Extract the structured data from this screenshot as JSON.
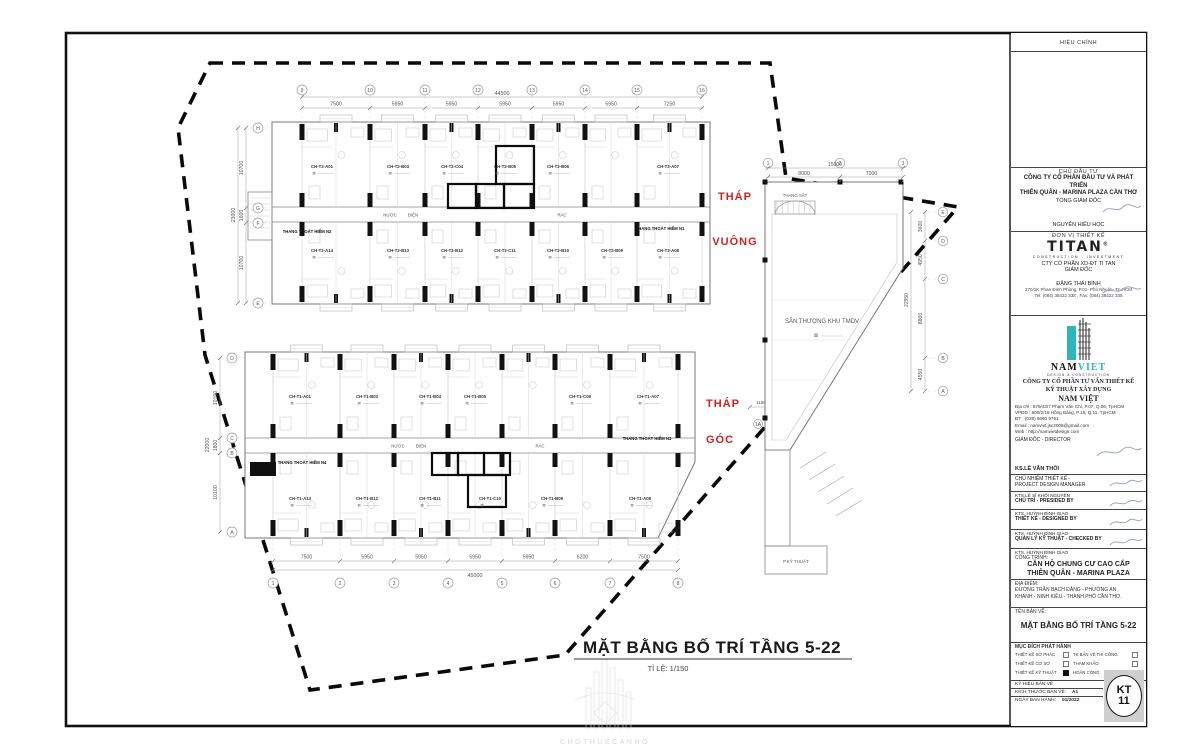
{
  "sheet": {
    "main_title": "MẶT BẰNG BỐ TRÍ TẦNG 5-22",
    "scale_label": "TỈ LỆ: 1/150",
    "watermark_text": "CHOTHUECANHO"
  },
  "annotations": {
    "tower_square_line1": "THÁP",
    "tower_square_line2": "VUÔNG",
    "tower_corner_line1": "THÁP",
    "tower_corner_line2": "GÓC",
    "terrace_label": "SÂN THƯỢNG KHU TMDV",
    "steel_stair_label": "THANG SẮT",
    "tech_room_label": "P.KỸ THUẬT"
  },
  "upper_plan": {
    "grids_top": [
      "9",
      "10",
      "11",
      "12",
      "13",
      "14",
      "15",
      "16"
    ],
    "dims_top": [
      "7500",
      "5950",
      "5950",
      "5950",
      "5950",
      "5950",
      "7250"
    ],
    "total_top": "44500",
    "grids_left": [
      "H",
      "G",
      "F",
      "E"
    ],
    "dims_left": [
      "10700",
      "1600",
      "10700"
    ],
    "total_left": "23000",
    "units_top": [
      "CH-T2-A01",
      "CH-T2-B03",
      "CH-T2-C04",
      "CH-T2-B05",
      "CH-T2-B06",
      "CH-T2-A07"
    ],
    "units_bottom": [
      "CH-T2-A14",
      "CH-T2-B13",
      "CH-T2-B12",
      "CH-T2-C11",
      "CH-T2-B10",
      "CH-T2-B09",
      "CH-T2-A08"
    ],
    "stair_left": "THANG THOÁT HIỂM N2",
    "stair_right": "THANG THOÁT HIỂM N1",
    "service_labels": [
      "NƯỚC",
      "ĐIỆN",
      "RÁC"
    ]
  },
  "lower_plan": {
    "grids_bottom": [
      "1",
      "2",
      "3",
      "4",
      "5",
      "6",
      "7",
      "8"
    ],
    "dims_bottom": [
      "7500",
      "5950",
      "5950",
      "5950",
      "5950",
      "6200",
      "7500"
    ],
    "total_bottom": "45000",
    "grids_left": [
      "D",
      "C",
      "B",
      "A"
    ],
    "dims_left": [
      "10100",
      "1800",
      "10100"
    ],
    "total_left": "22000",
    "units_top": [
      "CH-T1-A01",
      "CH-T1-B03",
      "CH-T1-B04",
      "CH-T1-B05",
      "CH-T1-C06",
      "CH-T1-A07"
    ],
    "units_bottom": [
      "CH-T1-A13",
      "CH-T1-B12",
      "CH-T1-B11",
      "CH-T1-C10",
      "CH-T1-B09",
      "CH-T1-A08"
    ],
    "stair_left": "THANG THOÁT HIỂM N4",
    "stair_right": "THANG THOÁT HIỂM N3",
    "service_labels": [
      "NƯỚC",
      "ĐIỆN",
      "RÁC"
    ],
    "corner_dims": [
      "1150",
      "950",
      "2100"
    ],
    "corner_grids": [
      "1A",
      "1B"
    ]
  },
  "wing_plan": {
    "grids_top": [
      "1",
      "2",
      "3"
    ],
    "dims_top": [
      "8000",
      "7000"
    ],
    "total_top": "15000",
    "grids_right": [
      "E",
      "D",
      "C",
      "B",
      "A"
    ],
    "dims_right": [
      "3600",
      "4950",
      "8800",
      "4550"
    ],
    "total_right": "22950"
  },
  "title_block": {
    "revision_header": "HIỆU CHỈNH",
    "investor_header": "CHỦ ĐẦU TƯ",
    "investor_name1": "CÔNG TY CỔ PHẦN ĐẦU TƯ VÀ PHÁT TRIỂN",
    "investor_name2": "THIÊN QUÂN - MARINA PLAZA CẦN THƠ",
    "investor_role": "TỔNG GIÁM ĐỐC",
    "investor_signer": "NGUYỄN HIẾU HỌC",
    "designer_header": "ĐƠN VỊ THIẾT KẾ",
    "titan_word": "TITAN",
    "titan_reg": "®",
    "titan_sub": "CONSTRUCTION - INVESTMENT",
    "titan_company": "CTY CỔ PHẦN XD-ĐT TI TAN",
    "titan_role": "GIÁM ĐỐC",
    "titan_signer": "ĐẶNG THÁI BÌNH",
    "titan_addr": "270/1K Phan Đình Phùng, P.01- Phú Nhuận- Tp.HCM",
    "titan_tel": "Tel: (084) 38422 338 , Fax: (084) 38422 335",
    "nv_nam": "NAM",
    "nv_viet": "VIET",
    "nv_logo_sub": "DESIGN & CONSTRUCTION",
    "nv_line1": "CÔNG TY CỔ PHẦN TƯ VẤN THIẾT KẾ",
    "nv_line2": "KỸ THUẬT XÂY DỰNG",
    "nv_name": "NAM VIỆT",
    "nv_addr1": "Địa chỉ : 579/43/7 Phạm Văn Chí, P.07, Q.06, TpHCM",
    "nv_addr2": "VPĐD : 600/2/18 Hồng Bàng, P.16, Q.11, TpHCM",
    "nv_addr3": "ĐT : (028) 6660 9761",
    "nv_addr4": "Email : namviet.jsc2008@gmail.com",
    "nv_addr5": "Web : http://namvietdesign.com",
    "nv_role": "GIÁM ĐỐC - DIRECTOR",
    "nv_signer": "KS.LÊ VĂN THỐI",
    "pm_label1": "CHỦ NHIỆM THIẾT KẾ -",
    "pm_label2": "PROJECT DESIGN MANAGER",
    "pm_name": "KTS.LÊ SĨ KHÔI NGUYÊN",
    "presided_label": "CHỦ TRÌ - PRESIDED  BY",
    "presided_name": "KTS. HUỲNH ĐÌNH GIAO",
    "designed_label": "THIẾT KẾ - DESIGNED BY",
    "designed_name": "KTS. HUỲNH ĐÌNH GIAO",
    "checked_label": "QUẢN LÝ KỸ THUẬT - CHECKED BY",
    "checked_name": "KTS. HUỲNH ĐÌNH GIAO",
    "project_header": "CÔNG TRÌNH:",
    "project_name1": "CĂN HỘ CHUNG CƯ CAO CẤP",
    "project_name2": "THIÊN QUÂN - MARINA PLAZA",
    "location_header": "ĐỊA ĐIỂM:",
    "location_line1": "ĐƯỜNG TRẦN BẠCH ĐẰNG - PHƯỜNG AN",
    "location_line2": "KHÁNH - NINH KIỀU - THÀNH PHỐ CẦN THƠ.",
    "drawing_header": "TÊN BẢN VẼ:",
    "drawing_name": "MẶT BẰNG BỐ TRÍ TẦNG 5-22",
    "purpose_header": "MỤC ĐÍCH PHÁT HÀNH",
    "purpose_items": [
      {
        "label": "THIẾT KẾ SƠ PHÁC",
        "checked": false
      },
      {
        "label": "TK BẢN VẼ THI CÔNG",
        "checked": false
      },
      {
        "label": "THIẾT KẾ CƠ SỞ",
        "checked": false
      },
      {
        "label": "THAM KHẢO",
        "checked": false
      },
      {
        "label": "THIẾT KẾ KỸ THUẬT",
        "checked": true
      },
      {
        "label": "HOÀN CÔNG",
        "checked": false
      }
    ],
    "symbol_label": "KÝ HIỆU BẢN VẼ",
    "size_label": "KÍCH THƯỚC BẢN VẼ:",
    "size_value": "A1",
    "date_label": "NGÀY BAN HÀNH:",
    "date_value": "01/2022",
    "sheet_code_top": "KT",
    "sheet_code_bottom": "11"
  },
  "colors": {
    "red_label": "#d42020",
    "teal_brand": "#2ab7bd",
    "line_dark": "#111111",
    "line_light": "#c6c6c6"
  }
}
